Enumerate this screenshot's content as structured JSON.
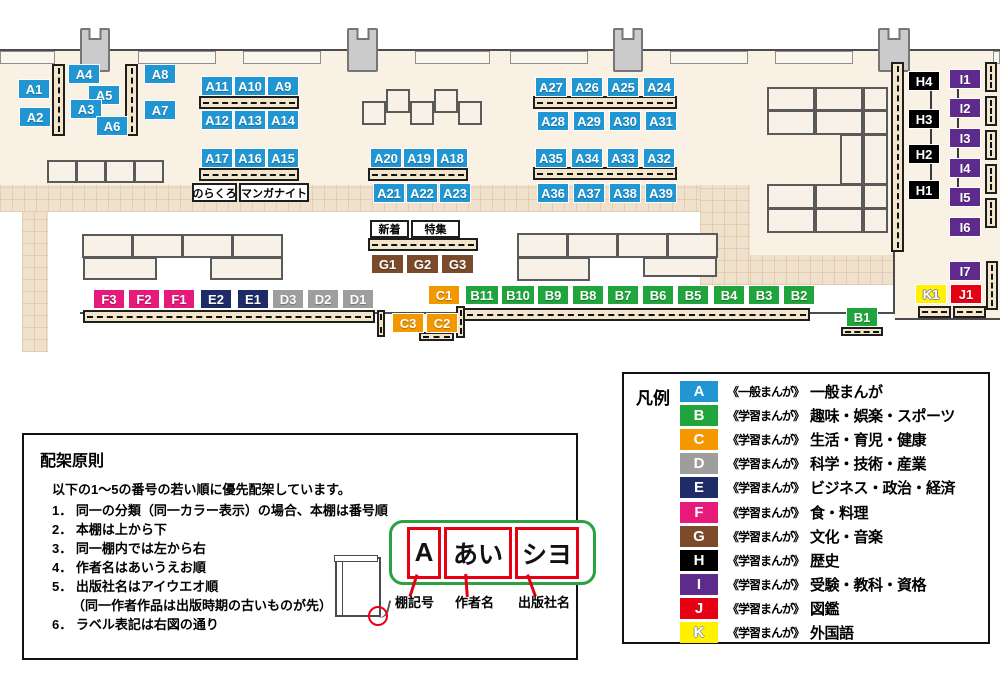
{
  "palette": {
    "A": "#2097d3",
    "B": "#1fa53c",
    "C": "#f39800",
    "D": "#9e9e9f",
    "E": "#1d2b67",
    "F": "#e7197b",
    "G": "#7a4a2b",
    "H": "#000000",
    "I": "#5e2b8d",
    "J": "#e60012",
    "K": "#fff100",
    "shelf_fill": "#f3e5c9",
    "floor": "#f9f2e4",
    "walkway": "#efe1cc",
    "diagram_green": "#2aa23f",
    "diagram_red": "#e60012"
  },
  "map": {
    "floors": [
      {
        "x": 0,
        "y": 50,
        "w": 1000,
        "h": 138
      },
      {
        "x": 750,
        "y": 185,
        "w": 143,
        "h": 70
      },
      {
        "x": 893,
        "y": 50,
        "w": 107,
        "h": 270
      }
    ],
    "walkways": [
      {
        "x": 0,
        "y": 185,
        "w": 750,
        "h": 27
      },
      {
        "x": 22,
        "y": 212,
        "w": 26,
        "h": 140
      },
      {
        "x": 700,
        "y": 185,
        "w": 50,
        "h": 100
      },
      {
        "x": 750,
        "y": 255,
        "w": 143,
        "h": 30
      }
    ],
    "walls": [
      {
        "x": 0,
        "y": 49,
        "w": 1000,
        "h": 2
      },
      {
        "x": 80,
        "y": 312,
        "w": 815,
        "h": 2
      },
      {
        "x": 893,
        "y": 252,
        "w": 2,
        "h": 62
      },
      {
        "x": 895,
        "y": 318,
        "w": 105,
        "h": 2
      }
    ],
    "counters": [
      {
        "x": 0,
        "y": 51,
        "w": 55,
        "h": 13
      },
      {
        "x": 138,
        "y": 51,
        "w": 78,
        "h": 13
      },
      {
        "x": 243,
        "y": 51,
        "w": 78,
        "h": 13
      },
      {
        "x": 415,
        "y": 51,
        "w": 75,
        "h": 13
      },
      {
        "x": 510,
        "y": 51,
        "w": 78,
        "h": 13
      },
      {
        "x": 670,
        "y": 51,
        "w": 78,
        "h": 13
      },
      {
        "x": 775,
        "y": 51,
        "w": 78,
        "h": 13
      },
      {
        "x": 993,
        "y": 51,
        "w": 7,
        "h": 13
      }
    ],
    "pillars": [
      {
        "x": 80,
        "y": 28,
        "w": 30,
        "h": 44
      },
      {
        "x": 347,
        "y": 28,
        "w": 31,
        "h": 44
      },
      {
        "x": 613,
        "y": 28,
        "w": 30,
        "h": 44
      },
      {
        "x": 878,
        "y": 28,
        "w": 32,
        "h": 44
      }
    ],
    "furniture": [
      {
        "x": 362,
        "y": 101,
        "w": 24,
        "h": 24
      },
      {
        "x": 386,
        "y": 89,
        "w": 24,
        "h": 24
      },
      {
        "x": 410,
        "y": 101,
        "w": 24,
        "h": 24
      },
      {
        "x": 434,
        "y": 89,
        "w": 24,
        "h": 24
      },
      {
        "x": 458,
        "y": 101,
        "w": 24,
        "h": 24
      },
      {
        "x": 47,
        "y": 160,
        "w": 30,
        "h": 23
      },
      {
        "x": 76,
        "y": 160,
        "w": 30,
        "h": 23
      },
      {
        "x": 105,
        "y": 160,
        "w": 30,
        "h": 23
      },
      {
        "x": 134,
        "y": 160,
        "w": 30,
        "h": 23
      },
      {
        "x": 82,
        "y": 234,
        "w": 51,
        "h": 24
      },
      {
        "x": 132,
        "y": 234,
        "w": 51,
        "h": 24
      },
      {
        "x": 182,
        "y": 234,
        "w": 51,
        "h": 24
      },
      {
        "x": 232,
        "y": 234,
        "w": 51,
        "h": 24
      },
      {
        "x": 83,
        "y": 257,
        "w": 74,
        "h": 23
      },
      {
        "x": 210,
        "y": 257,
        "w": 73,
        "h": 23
      },
      {
        "x": 517,
        "y": 233,
        "w": 51,
        "h": 25
      },
      {
        "x": 567,
        "y": 233,
        "w": 51,
        "h": 25
      },
      {
        "x": 617,
        "y": 233,
        "w": 51,
        "h": 25
      },
      {
        "x": 667,
        "y": 233,
        "w": 51,
        "h": 25
      },
      {
        "x": 517,
        "y": 257,
        "w": 73,
        "h": 24
      },
      {
        "x": 643,
        "y": 257,
        "w": 74,
        "h": 20
      },
      {
        "x": 767,
        "y": 87,
        "w": 48,
        "h": 24
      },
      {
        "x": 815,
        "y": 87,
        "w": 48,
        "h": 24
      },
      {
        "x": 863,
        "y": 87,
        "w": 25,
        "h": 24
      },
      {
        "x": 767,
        "y": 110,
        "w": 48,
        "h": 25
      },
      {
        "x": 815,
        "y": 110,
        "w": 48,
        "h": 25
      },
      {
        "x": 863,
        "y": 110,
        "w": 25,
        "h": 25
      },
      {
        "x": 840,
        "y": 134,
        "w": 23,
        "h": 51
      },
      {
        "x": 863,
        "y": 134,
        "w": 25,
        "h": 51
      },
      {
        "x": 767,
        "y": 184,
        "w": 48,
        "h": 25
      },
      {
        "x": 815,
        "y": 184,
        "w": 48,
        "h": 25
      },
      {
        "x": 863,
        "y": 184,
        "w": 25,
        "h": 25
      },
      {
        "x": 767,
        "y": 208,
        "w": 48,
        "h": 25
      },
      {
        "x": 815,
        "y": 208,
        "w": 48,
        "h": 25
      },
      {
        "x": 863,
        "y": 208,
        "w": 25,
        "h": 25
      }
    ],
    "shelves": [
      {
        "x": 52,
        "y": 64,
        "w": 13,
        "h": 72,
        "o": "v"
      },
      {
        "x": 125,
        "y": 64,
        "w": 13,
        "h": 72,
        "o": "v"
      },
      {
        "x": 199,
        "y": 96,
        "w": 100,
        "h": 13,
        "o": "h"
      },
      {
        "x": 199,
        "y": 168,
        "w": 100,
        "h": 13,
        "o": "h"
      },
      {
        "x": 368,
        "y": 168,
        "w": 100,
        "h": 13,
        "o": "h"
      },
      {
        "x": 533,
        "y": 96,
        "w": 144,
        "h": 13,
        "o": "h"
      },
      {
        "x": 533,
        "y": 167,
        "w": 144,
        "h": 13,
        "o": "h"
      },
      {
        "x": 368,
        "y": 238,
        "w": 110,
        "h": 13,
        "o": "h"
      },
      {
        "x": 83,
        "y": 310,
        "w": 292,
        "h": 13,
        "o": "h"
      },
      {
        "x": 463,
        "y": 308,
        "w": 347,
        "h": 13,
        "o": "h"
      },
      {
        "x": 377,
        "y": 310,
        "w": 8,
        "h": 27,
        "o": "v"
      },
      {
        "x": 456,
        "y": 306,
        "w": 9,
        "h": 32,
        "o": "v"
      },
      {
        "x": 419,
        "y": 332,
        "w": 35,
        "h": 9,
        "o": "h"
      },
      {
        "x": 841,
        "y": 327,
        "w": 42,
        "h": 9,
        "o": "h"
      },
      {
        "x": 918,
        "y": 306,
        "w": 33,
        "h": 12,
        "o": "h"
      },
      {
        "x": 953,
        "y": 306,
        "w": 33,
        "h": 12,
        "o": "h"
      },
      {
        "x": 891,
        "y": 62,
        "w": 13,
        "h": 190,
        "o": "v"
      },
      {
        "x": 985,
        "y": 62,
        "w": 12,
        "h": 30,
        "o": "v"
      },
      {
        "x": 985,
        "y": 96,
        "w": 12,
        "h": 30,
        "o": "v"
      },
      {
        "x": 985,
        "y": 130,
        "w": 12,
        "h": 30,
        "o": "v"
      },
      {
        "x": 985,
        "y": 164,
        "w": 12,
        "h": 30,
        "o": "v"
      },
      {
        "x": 985,
        "y": 198,
        "w": 12,
        "h": 30,
        "o": "v"
      },
      {
        "x": 986,
        "y": 261,
        "w": 12,
        "h": 49,
        "o": "v"
      }
    ],
    "leaders": [
      {
        "x": 930,
        "y": 80,
        "w": 2,
        "h": 118
      },
      {
        "x": 957,
        "y": 76,
        "w": 2,
        "h": 122
      }
    ],
    "shelf_labels": [
      {
        "id": "A1",
        "x": 18,
        "y": 79
      },
      {
        "id": "A2",
        "x": 19,
        "y": 107
      },
      {
        "id": "A4",
        "x": 68,
        "y": 64
      },
      {
        "id": "A5",
        "x": 88,
        "y": 85
      },
      {
        "id": "A3",
        "x": 70,
        "y": 99
      },
      {
        "id": "A6",
        "x": 96,
        "y": 116
      },
      {
        "id": "A8",
        "x": 144,
        "y": 64
      },
      {
        "id": "A7",
        "x": 144,
        "y": 100
      },
      {
        "id": "A11",
        "x": 201,
        "y": 76
      },
      {
        "id": "A10",
        "x": 234,
        "y": 76
      },
      {
        "id": "A9",
        "x": 267,
        "y": 76
      },
      {
        "id": "A12",
        "x": 201,
        "y": 110
      },
      {
        "id": "A13",
        "x": 234,
        "y": 110
      },
      {
        "id": "A14",
        "x": 267,
        "y": 110
      },
      {
        "id": "A17",
        "x": 201,
        "y": 148
      },
      {
        "id": "A16",
        "x": 234,
        "y": 148
      },
      {
        "id": "A15",
        "x": 267,
        "y": 148
      },
      {
        "id": "A20",
        "x": 370,
        "y": 148
      },
      {
        "id": "A19",
        "x": 403,
        "y": 148
      },
      {
        "id": "A18",
        "x": 436,
        "y": 148
      },
      {
        "id": "A21",
        "x": 373,
        "y": 183
      },
      {
        "id": "A22",
        "x": 406,
        "y": 183
      },
      {
        "id": "A23",
        "x": 439,
        "y": 183
      },
      {
        "id": "A27",
        "x": 535,
        "y": 77
      },
      {
        "id": "A26",
        "x": 571,
        "y": 77
      },
      {
        "id": "A25",
        "x": 607,
        "y": 77
      },
      {
        "id": "A24",
        "x": 643,
        "y": 77
      },
      {
        "id": "A28",
        "x": 537,
        "y": 111
      },
      {
        "id": "A29",
        "x": 573,
        "y": 111
      },
      {
        "id": "A30",
        "x": 609,
        "y": 111
      },
      {
        "id": "A31",
        "x": 645,
        "y": 111
      },
      {
        "id": "A35",
        "x": 535,
        "y": 148
      },
      {
        "id": "A34",
        "x": 571,
        "y": 148
      },
      {
        "id": "A33",
        "x": 607,
        "y": 148
      },
      {
        "id": "A32",
        "x": 643,
        "y": 148
      },
      {
        "id": "A36",
        "x": 537,
        "y": 183
      },
      {
        "id": "A37",
        "x": 573,
        "y": 183
      },
      {
        "id": "A38",
        "x": 609,
        "y": 183
      },
      {
        "id": "A39",
        "x": 645,
        "y": 183
      },
      {
        "id": "G1",
        "x": 371,
        "y": 254,
        "w": 33
      },
      {
        "id": "G2",
        "x": 406,
        "y": 254,
        "w": 33
      },
      {
        "id": "G3",
        "x": 441,
        "y": 254,
        "w": 33
      },
      {
        "id": "F3",
        "x": 93,
        "y": 289
      },
      {
        "id": "F2",
        "x": 128,
        "y": 289
      },
      {
        "id": "F1",
        "x": 163,
        "y": 289
      },
      {
        "id": "E2",
        "x": 200,
        "y": 289
      },
      {
        "id": "E1",
        "x": 237,
        "y": 289
      },
      {
        "id": "D3",
        "x": 272,
        "y": 289
      },
      {
        "id": "D2",
        "x": 307,
        "y": 289
      },
      {
        "id": "D1",
        "x": 342,
        "y": 289
      },
      {
        "id": "C1",
        "x": 428,
        "y": 285
      },
      {
        "id": "B11",
        "x": 465,
        "y": 285,
        "w": 34
      },
      {
        "id": "B10",
        "x": 501,
        "y": 285,
        "w": 34
      },
      {
        "id": "B9",
        "x": 537,
        "y": 285
      },
      {
        "id": "B8",
        "x": 572,
        "y": 285
      },
      {
        "id": "B7",
        "x": 607,
        "y": 285
      },
      {
        "id": "B6",
        "x": 642,
        "y": 285
      },
      {
        "id": "B5",
        "x": 677,
        "y": 285
      },
      {
        "id": "B4",
        "x": 713,
        "y": 285
      },
      {
        "id": "B3",
        "x": 748,
        "y": 285
      },
      {
        "id": "B2",
        "x": 783,
        "y": 285
      },
      {
        "id": "C3",
        "x": 392,
        "y": 313
      },
      {
        "id": "C2",
        "x": 426,
        "y": 313
      },
      {
        "id": "B1",
        "x": 846,
        "y": 307
      },
      {
        "id": "H4",
        "x": 908,
        "y": 71
      },
      {
        "id": "H3",
        "x": 908,
        "y": 109
      },
      {
        "id": "H2",
        "x": 908,
        "y": 144
      },
      {
        "id": "H1",
        "x": 908,
        "y": 180
      },
      {
        "id": "I1",
        "x": 949,
        "y": 69
      },
      {
        "id": "I2",
        "x": 949,
        "y": 98
      },
      {
        "id": "I3",
        "x": 949,
        "y": 128
      },
      {
        "id": "I4",
        "x": 949,
        "y": 158
      },
      {
        "id": "I5",
        "x": 949,
        "y": 187
      },
      {
        "id": "I6",
        "x": 949,
        "y": 217
      },
      {
        "id": "I7",
        "x": 949,
        "y": 261
      },
      {
        "id": "K1",
        "x": 915,
        "y": 284
      },
      {
        "id": "J1",
        "x": 950,
        "y": 284
      }
    ],
    "annotations": [
      {
        "id": "norakuro",
        "text": "のらくろ",
        "x": 192,
        "y": 183,
        "w": 45,
        "h": 19
      },
      {
        "id": "manga-night",
        "text": "マンガナイト",
        "x": 239,
        "y": 183,
        "w": 70,
        "h": 19
      },
      {
        "id": "shinchaku",
        "text": "新着",
        "x": 370,
        "y": 220,
        "w": 39,
        "h": 18
      },
      {
        "id": "tokushu",
        "text": "特集",
        "x": 411,
        "y": 220,
        "w": 49,
        "h": 18
      }
    ]
  },
  "legend": {
    "title": "凡例",
    "items": [
      {
        "key": "A",
        "type": "《一般まんが》",
        "label": "一般まんが"
      },
      {
        "key": "B",
        "type": "《学習まんが》",
        "label": "趣味・娯楽・スポーツ"
      },
      {
        "key": "C",
        "type": "《学習まんが》",
        "label": "生活・育児・健康"
      },
      {
        "key": "D",
        "type": "《学習まんが》",
        "label": "科学・技術・産業"
      },
      {
        "key": "E",
        "type": "《学習まんが》",
        "label": "ビジネス・政治・経済"
      },
      {
        "key": "F",
        "type": "《学習まんが》",
        "label": "食・料理"
      },
      {
        "key": "G",
        "type": "《学習まんが》",
        "label": "文化・音楽"
      },
      {
        "key": "H",
        "type": "《学習まんが》",
        "label": "歴史"
      },
      {
        "key": "I",
        "type": "《学習まんが》",
        "label": "受験・教科・資格"
      },
      {
        "key": "J",
        "type": "《学習まんが》",
        "label": "図鑑"
      },
      {
        "key": "K",
        "type": "《学習まんが》",
        "label": "外国語"
      }
    ]
  },
  "principles": {
    "title": "配架原則",
    "intro": "以下の1～5の番号の若い順に優先配架しています。",
    "items": [
      {
        "num": "1．",
        "text": "同一の分類（同一カラー表示）の場合、本棚は番号順"
      },
      {
        "num": "2．",
        "text": "本棚は上から下"
      },
      {
        "num": "3．",
        "text": "同一棚内では左から右"
      },
      {
        "num": "4．",
        "text": "作者名はあいうえお順"
      },
      {
        "num": "5．",
        "text": "出版社名はアイウエオ順",
        "note": "（同一作者作品は出版時期の古いものが先）"
      },
      {
        "num": "6．",
        "text": "ラベル表記は右図の通り"
      }
    ],
    "diagram": {
      "boxes": [
        "A",
        "あい",
        "シヨ"
      ],
      "captions": [
        "棚記号",
        "作者名",
        "出版社名"
      ]
    }
  }
}
